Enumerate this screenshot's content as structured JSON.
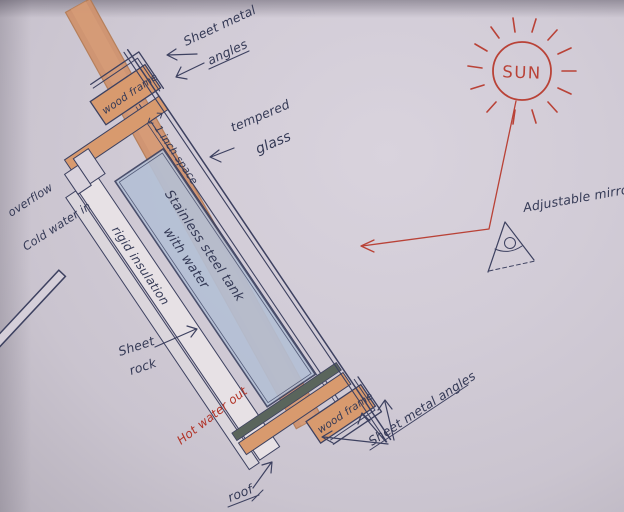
{
  "labels": {
    "sheet_metal_angles_top": {
      "line1": "Sheet metal",
      "line2": "angles"
    },
    "wood_frame_top": "wood frame",
    "one_inch_space": "1 inch space",
    "tempered_glass": {
      "line1": "tempered",
      "line2": "glass"
    },
    "tank": {
      "line1": "Stainless steel tank",
      "line2": "with water"
    },
    "rigid_insulation": "rigid insulation",
    "overflow": "overflow",
    "cold_water_in": "Cold water in",
    "sheet_rock": {
      "line1": "Sheet",
      "line2": "rock"
    },
    "hot_water_out": "Hot water out",
    "roof": "roof",
    "wood_frame_bottom": "wood frame",
    "sheet_metal_angles_bottom": "Sheet metal angles",
    "sun": "SUN",
    "adjustable_mirror": "Adjustable mirror"
  },
  "colors": {
    "ink": "#3d4160",
    "red_ink": "#b94237",
    "paper": "#d2ccd7",
    "wood": "#d89a6e",
    "roof_wood": "#d0916b",
    "tank_blue": "#b4c0d5",
    "tank_end_metal": "#5a655c",
    "insulation": "#e7e1e5",
    "sheet_rock_gray": "#dbd6dc"
  }
}
